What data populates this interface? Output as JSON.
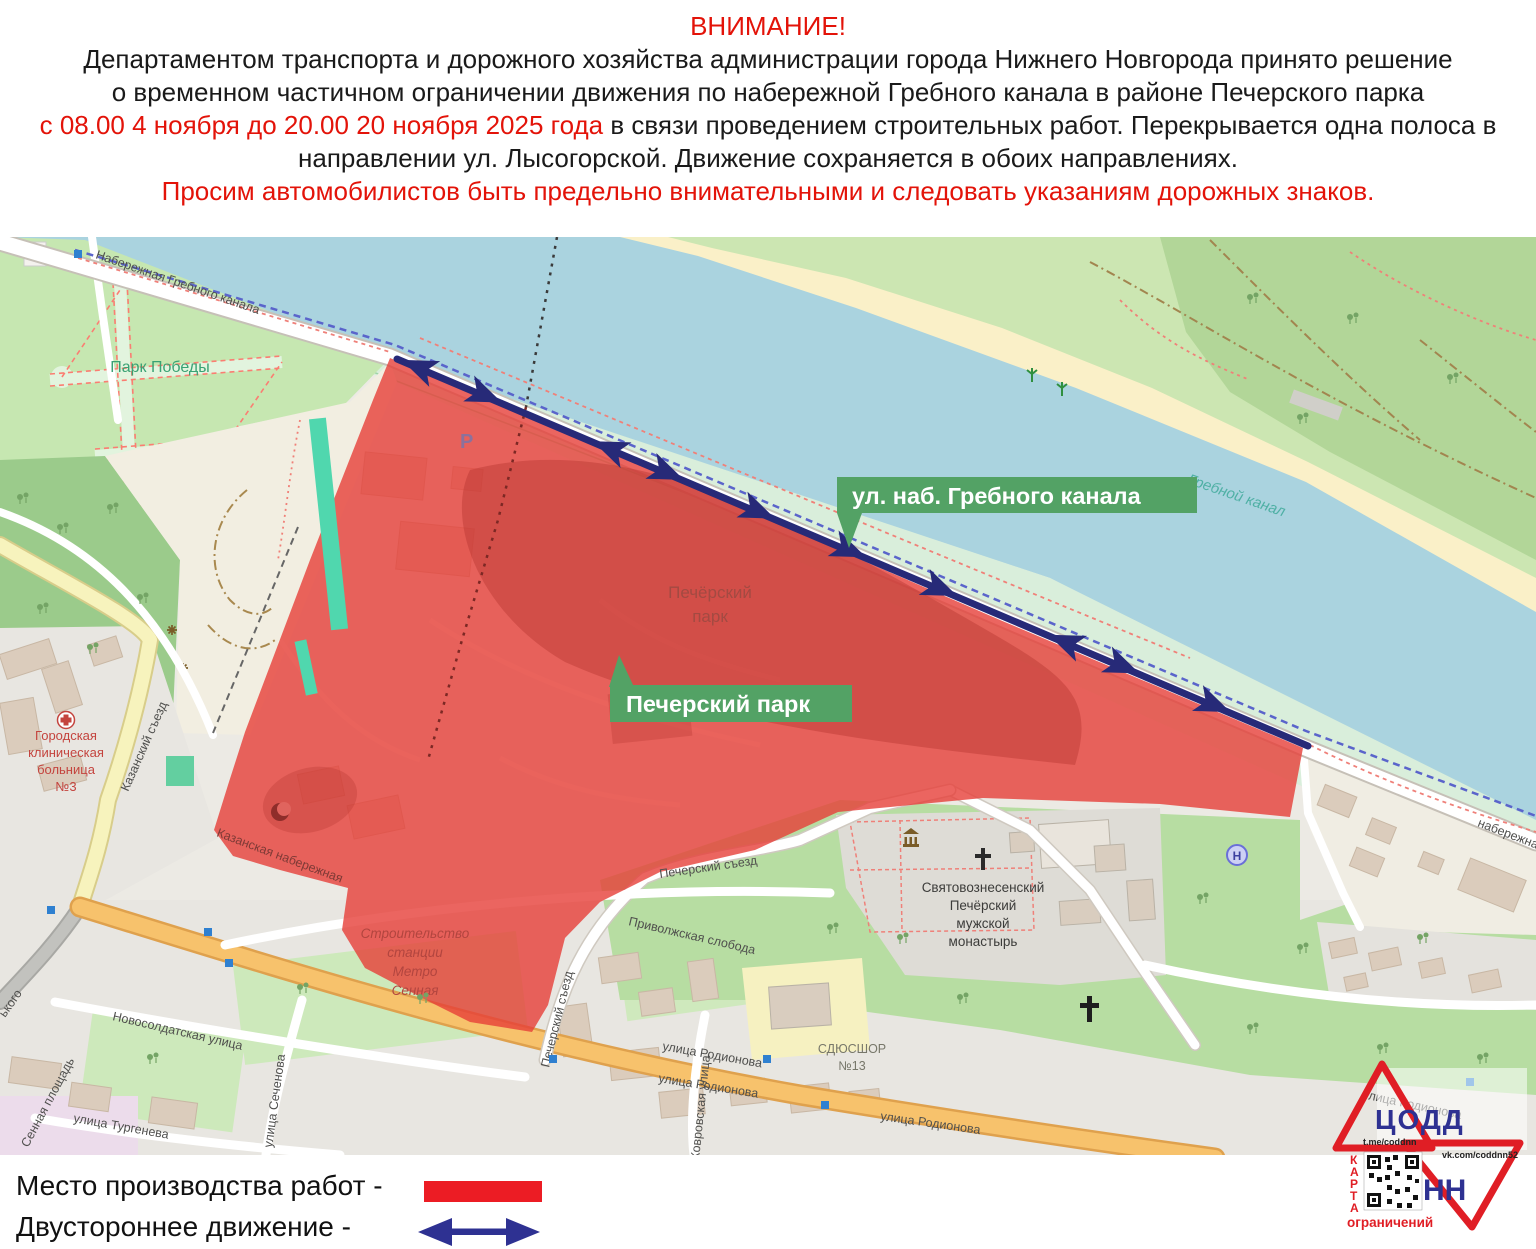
{
  "header": {
    "line1": "ВНИМАНИЕ!",
    "line2": "Департаментом транспорта и дорожного хозяйства администрации города Нижнего Новгорода принято решение",
    "line3": "о временном частичном ограничении движения по набережной Гребного канала в районе Печерского парка",
    "line4_red": "с 08.00 4 ноября до 20.00 20 ноября 2025 года",
    "line4_black": " в связи проведением строительных работ. Перекрывается одна полоса в",
    "line5": "направлении ул. Лысогорской. Движение сохраняется в обоих направлениях.",
    "line6": "Просим автомобилистов быть предельно внимательными и следовать указаниям дорожных знаков.",
    "accent_red": "#e31309",
    "text_black": "#1a1a1a"
  },
  "map": {
    "badges": {
      "embankment_label": "ул. наб. Гребного канала",
      "park_label": "Печерский парк",
      "badge_color": "#53a265"
    },
    "streets": {
      "naberezhnaya": "Набережная Гребного канала",
      "park_pobedy": "Парк Победы",
      "grebnoy_kanal": "Гребной канал",
      "kazansky_sezd": "Казанский съезд",
      "kazanskaya_nab": "Казанская набережная",
      "pechersky_sezd": "Печерский съезд",
      "privolzhskaya": "Приволжская слобода",
      "novosoldatskaya": "Новосолдатская улица",
      "sechenova": "улица Сеченова",
      "turgeneva": "улица Тургенева",
      "sennaya": "Сенная площадь",
      "gorkogo_frag": "ького",
      "kovrovskaya": "Ковровская улица",
      "rodionova": "улица Родионова",
      "naberezh_frag": "набережная"
    },
    "pois": {
      "park_label_1": "Печёрский",
      "park_label_2": "парк",
      "hospital": [
        "Городская",
        "клиническая",
        "больница",
        "№3"
      ],
      "monastery": [
        "Святовознесенский",
        "Печёрский",
        "мужской",
        "монастырь"
      ],
      "metro": [
        "Строительство",
        "станции",
        "Метро",
        "Сенная"
      ],
      "sdyushor": [
        "СДЮСШОР",
        "№13"
      ],
      "parking": "Р"
    },
    "overlay_red": "#e63e38",
    "arrow_navy": "#272a78",
    "water_color": "#aad3df"
  },
  "legend": {
    "work_label": "Место производства работ -",
    "two_way_label": "Двустороннее движение  -",
    "swatch_color": "#ec1c24",
    "arrow_color": "#2e3192"
  },
  "logo": {
    "org": "ЦОДД",
    "city": "НН",
    "tg": "t.me/coddnn",
    "vk": "vk.com/coddnn52",
    "karta": [
      "К",
      "А",
      "Р",
      "Т",
      "А"
    ],
    "restrictions": "ограничений",
    "red": "#e01e25",
    "blue": "#2e3192"
  }
}
